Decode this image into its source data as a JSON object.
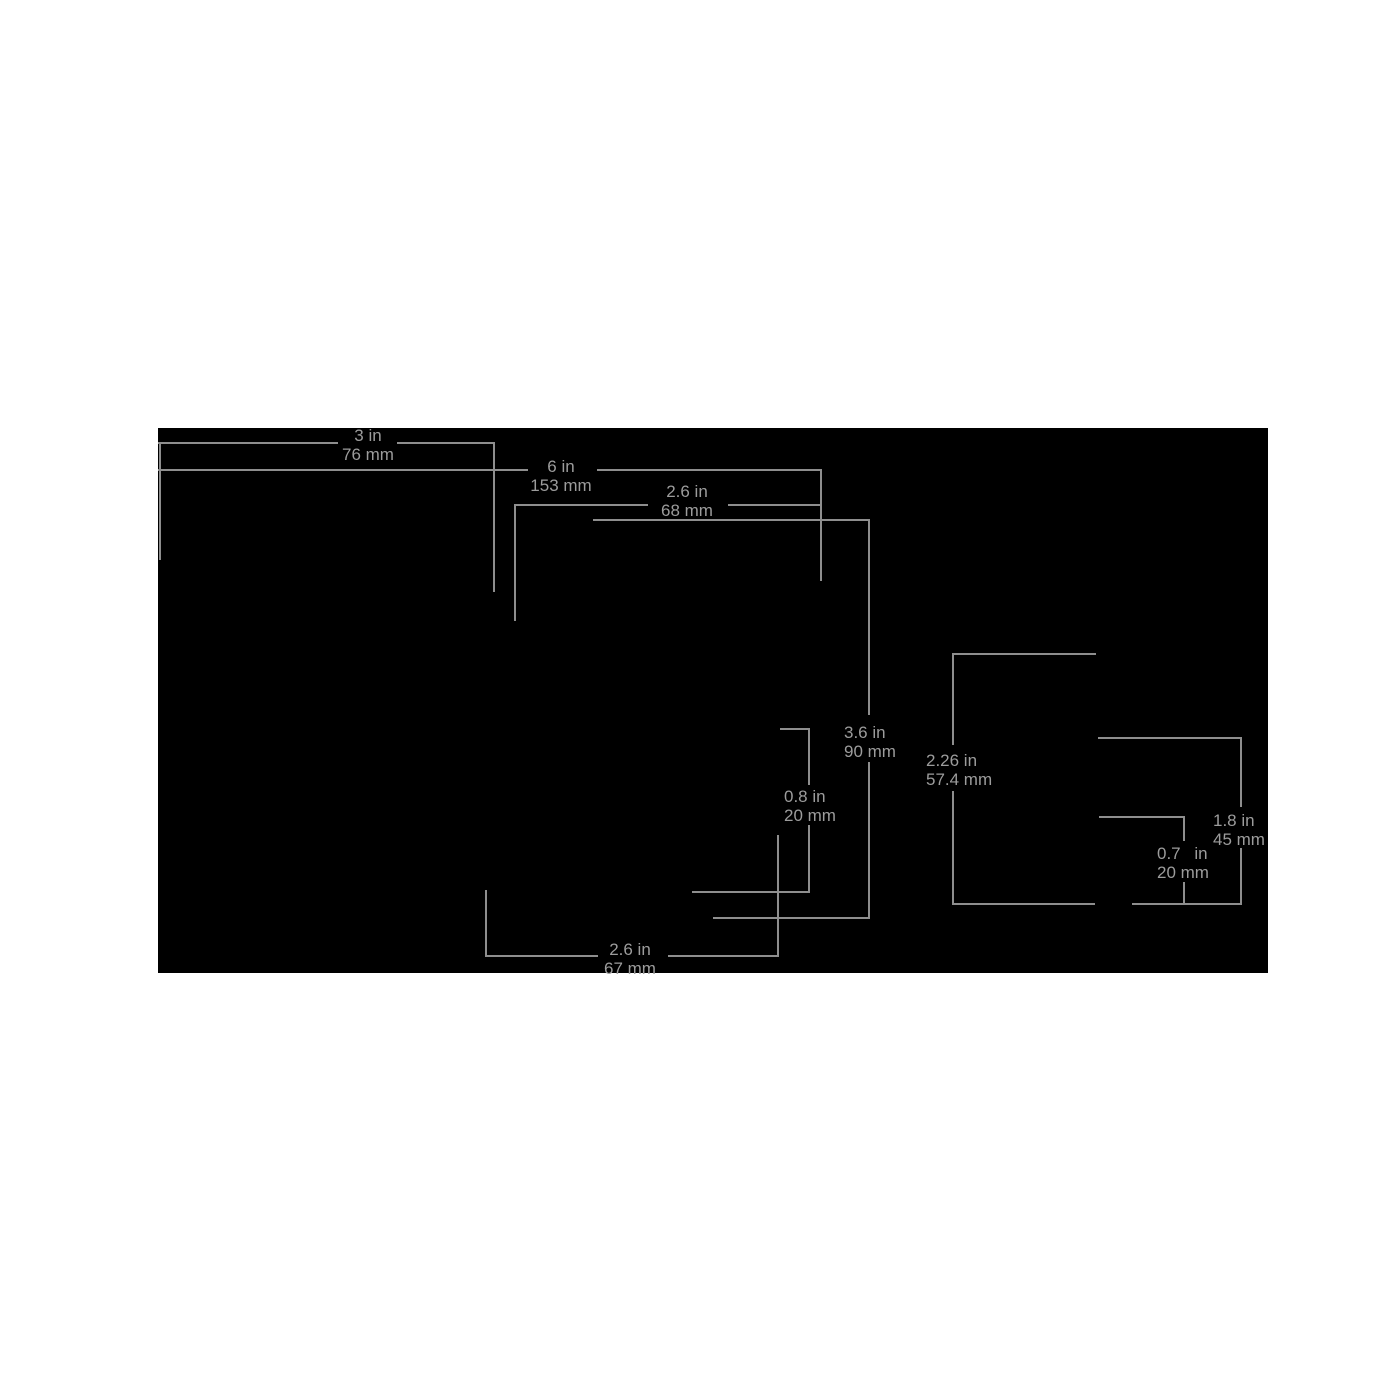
{
  "figure": {
    "background": "#000000",
    "page_background": "#ffffff",
    "line_color": "#8e8e8e",
    "text_color": "#9c9c9c"
  },
  "dimensions": [
    {
      "id": "top-width",
      "inches": "3 in",
      "mm": "76 mm"
    },
    {
      "id": "full-width",
      "inches": "6 in",
      "mm": "153 mm"
    },
    {
      "id": "upper-inner-width",
      "inches": "2.6 in",
      "mm": "68 mm"
    },
    {
      "id": "front-height",
      "inches": "3.6 in",
      "mm": "90 mm"
    },
    {
      "id": "notch-height",
      "inches": "0.8 in",
      "mm": "20 mm"
    },
    {
      "id": "bottom-width",
      "inches": "2.6 in",
      "mm": "67 mm"
    },
    {
      "id": "side-height",
      "inches": "2.26 in",
      "mm": "57.4 mm"
    },
    {
      "id": "side-lower-height",
      "inches": "1.8 in",
      "mm": "45 mm"
    },
    {
      "id": "side-depth",
      "inches": "0.7 in",
      "mm": "20 mm"
    }
  ]
}
